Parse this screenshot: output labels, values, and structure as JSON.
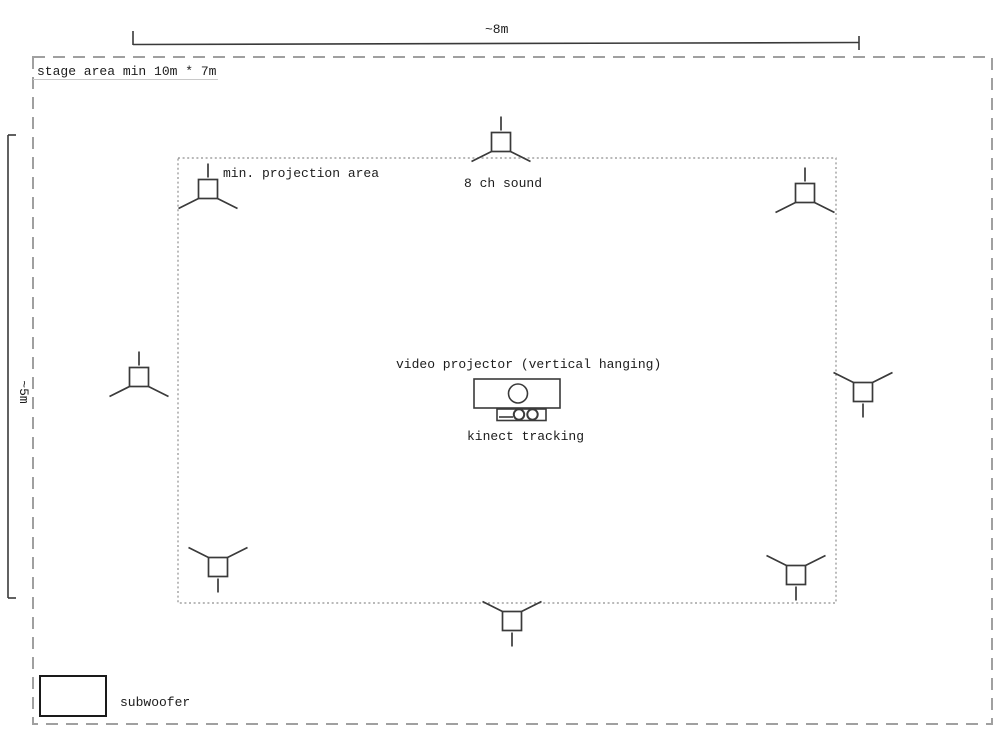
{
  "colors": {
    "line": "#3a3a3a",
    "text": "#1c1c1c",
    "dash_outer": "#a0a0a0",
    "dash_inner": "#8f8f8f",
    "faint": "#c9c9c9"
  },
  "dimensions": {
    "width_label": "~8m",
    "height_label": "~5m"
  },
  "labels": {
    "stage_area": "stage area min 10m * 7m",
    "projection_area": "min. projection area",
    "sound": "8 ch sound",
    "projector": "video projector (vertical hanging)",
    "kinect": "kinect tracking",
    "subwoofer": "subwoofer"
  },
  "speakers": [
    {
      "name": "speaker-top-left",
      "cx": 208,
      "cy": 189,
      "dir": "up"
    },
    {
      "name": "speaker-top-center",
      "cx": 501,
      "cy": 142,
      "dir": "up"
    },
    {
      "name": "speaker-top-right",
      "cx": 805,
      "cy": 193,
      "dir": "up"
    },
    {
      "name": "speaker-mid-left",
      "cx": 139,
      "cy": 377,
      "dir": "up"
    },
    {
      "name": "speaker-mid-right",
      "cx": 863,
      "cy": 392,
      "dir": "down"
    },
    {
      "name": "speaker-bottom-left",
      "cx": 218,
      "cy": 567,
      "dir": "down"
    },
    {
      "name": "speaker-bottom-center",
      "cx": 512,
      "cy": 621,
      "dir": "down"
    },
    {
      "name": "speaker-bottom-right",
      "cx": 796,
      "cy": 575,
      "dir": "down"
    }
  ]
}
